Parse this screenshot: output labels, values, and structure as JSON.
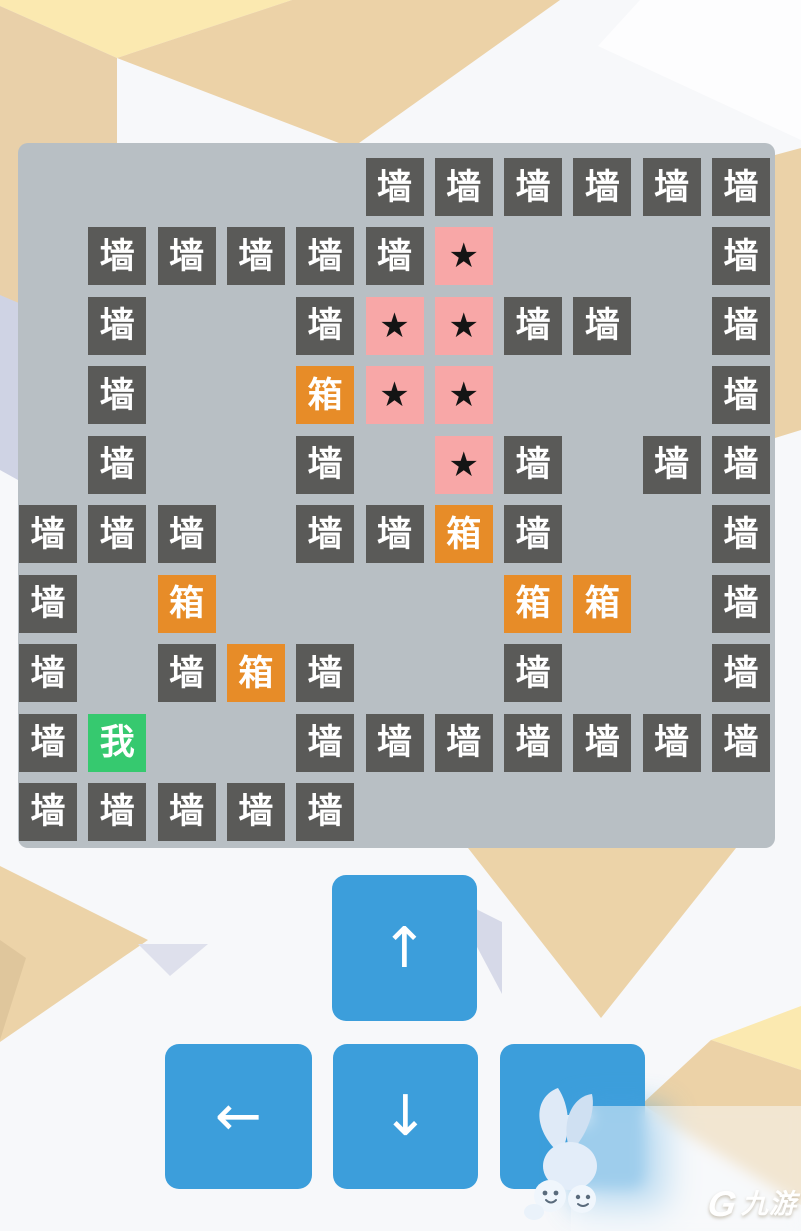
{
  "board": {
    "grid": [
      ".....WWWWWW",
      ".WWWWWS...W",
      ".W..WSSWW.W",
      ".W..BSS...W",
      ".W..W.SW.WW",
      "WWW.WWBW..W",
      "W.B....BB.W",
      "W.WBW..W..W",
      "WP..WWWWWWW",
      "WWWWW......"
    ],
    "legend": {
      "W": {
        "name": "wall",
        "label": "墙"
      },
      "B": {
        "name": "box",
        "label": "箱"
      },
      "S": {
        "name": "star",
        "label": "★"
      },
      "P": {
        "name": "player",
        "label": "我"
      }
    }
  },
  "controls": {
    "up": "↑",
    "left": "←",
    "down": "↓",
    "right": "→"
  },
  "watermark": {
    "mark": "G",
    "brand": "九游"
  },
  "colors": {
    "board_bg": "#b8bfc4",
    "wall_bg": "#5a5a58",
    "wall_fg": "#ffffff",
    "box_bg": "#e78c28",
    "box_fg": "#ffffff",
    "star_bg": "#f8a7a7",
    "star_fg": "#141414",
    "player_bg": "#36c96f",
    "player_fg": "#ffffff",
    "button_bg": "#3c9edb",
    "button_fg": "#ffffff"
  }
}
